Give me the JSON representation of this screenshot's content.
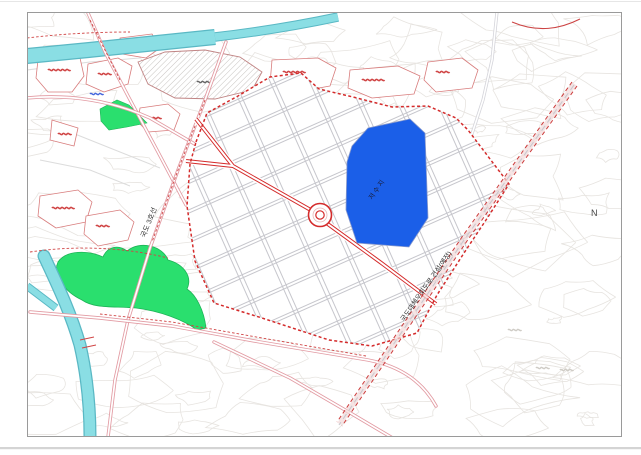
{
  "map": {
    "labels": {
      "route3": "국도 3호선",
      "bypass": "국도대체우회도로 건설(예정)",
      "reservoir": "저수지",
      "north_marker": "N"
    },
    "colors": {
      "water": "#8ADEE4",
      "water_edge": "#5AB8C4",
      "reservoir_fill": "#1B5FE8",
      "park_green": "#2ADF6E",
      "boundary_red": "#D42B2B",
      "road_pink": "#E29AA2",
      "road_red": "#D42B2B",
      "block_line_gray": "#C6C6CC",
      "contour_gray": "#E7E4E0",
      "frame_gray": "#9A9A9A"
    }
  }
}
